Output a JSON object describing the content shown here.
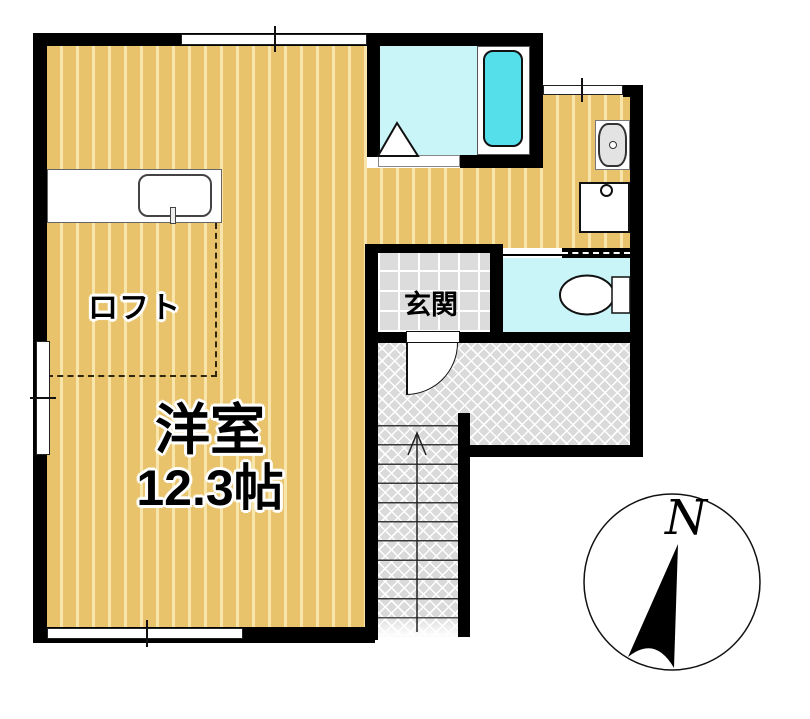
{
  "floorplan": {
    "labels": {
      "loft": "ロフト",
      "main_room_name": "洋室",
      "main_room_area": "12.3帖",
      "entrance": "玄関"
    },
    "compass": {
      "north": "N"
    },
    "colors": {
      "wall": "#000000",
      "wood_floor": "#e9c36b",
      "wood_stripe": "#f8e5ab",
      "bath_floor": "#c9f4f8",
      "bathtub": "#55dfeb",
      "tile_floor": "#dcdcdc",
      "hatch_floor": "#dadada",
      "fixture_gray": "#e3e3e3"
    }
  }
}
